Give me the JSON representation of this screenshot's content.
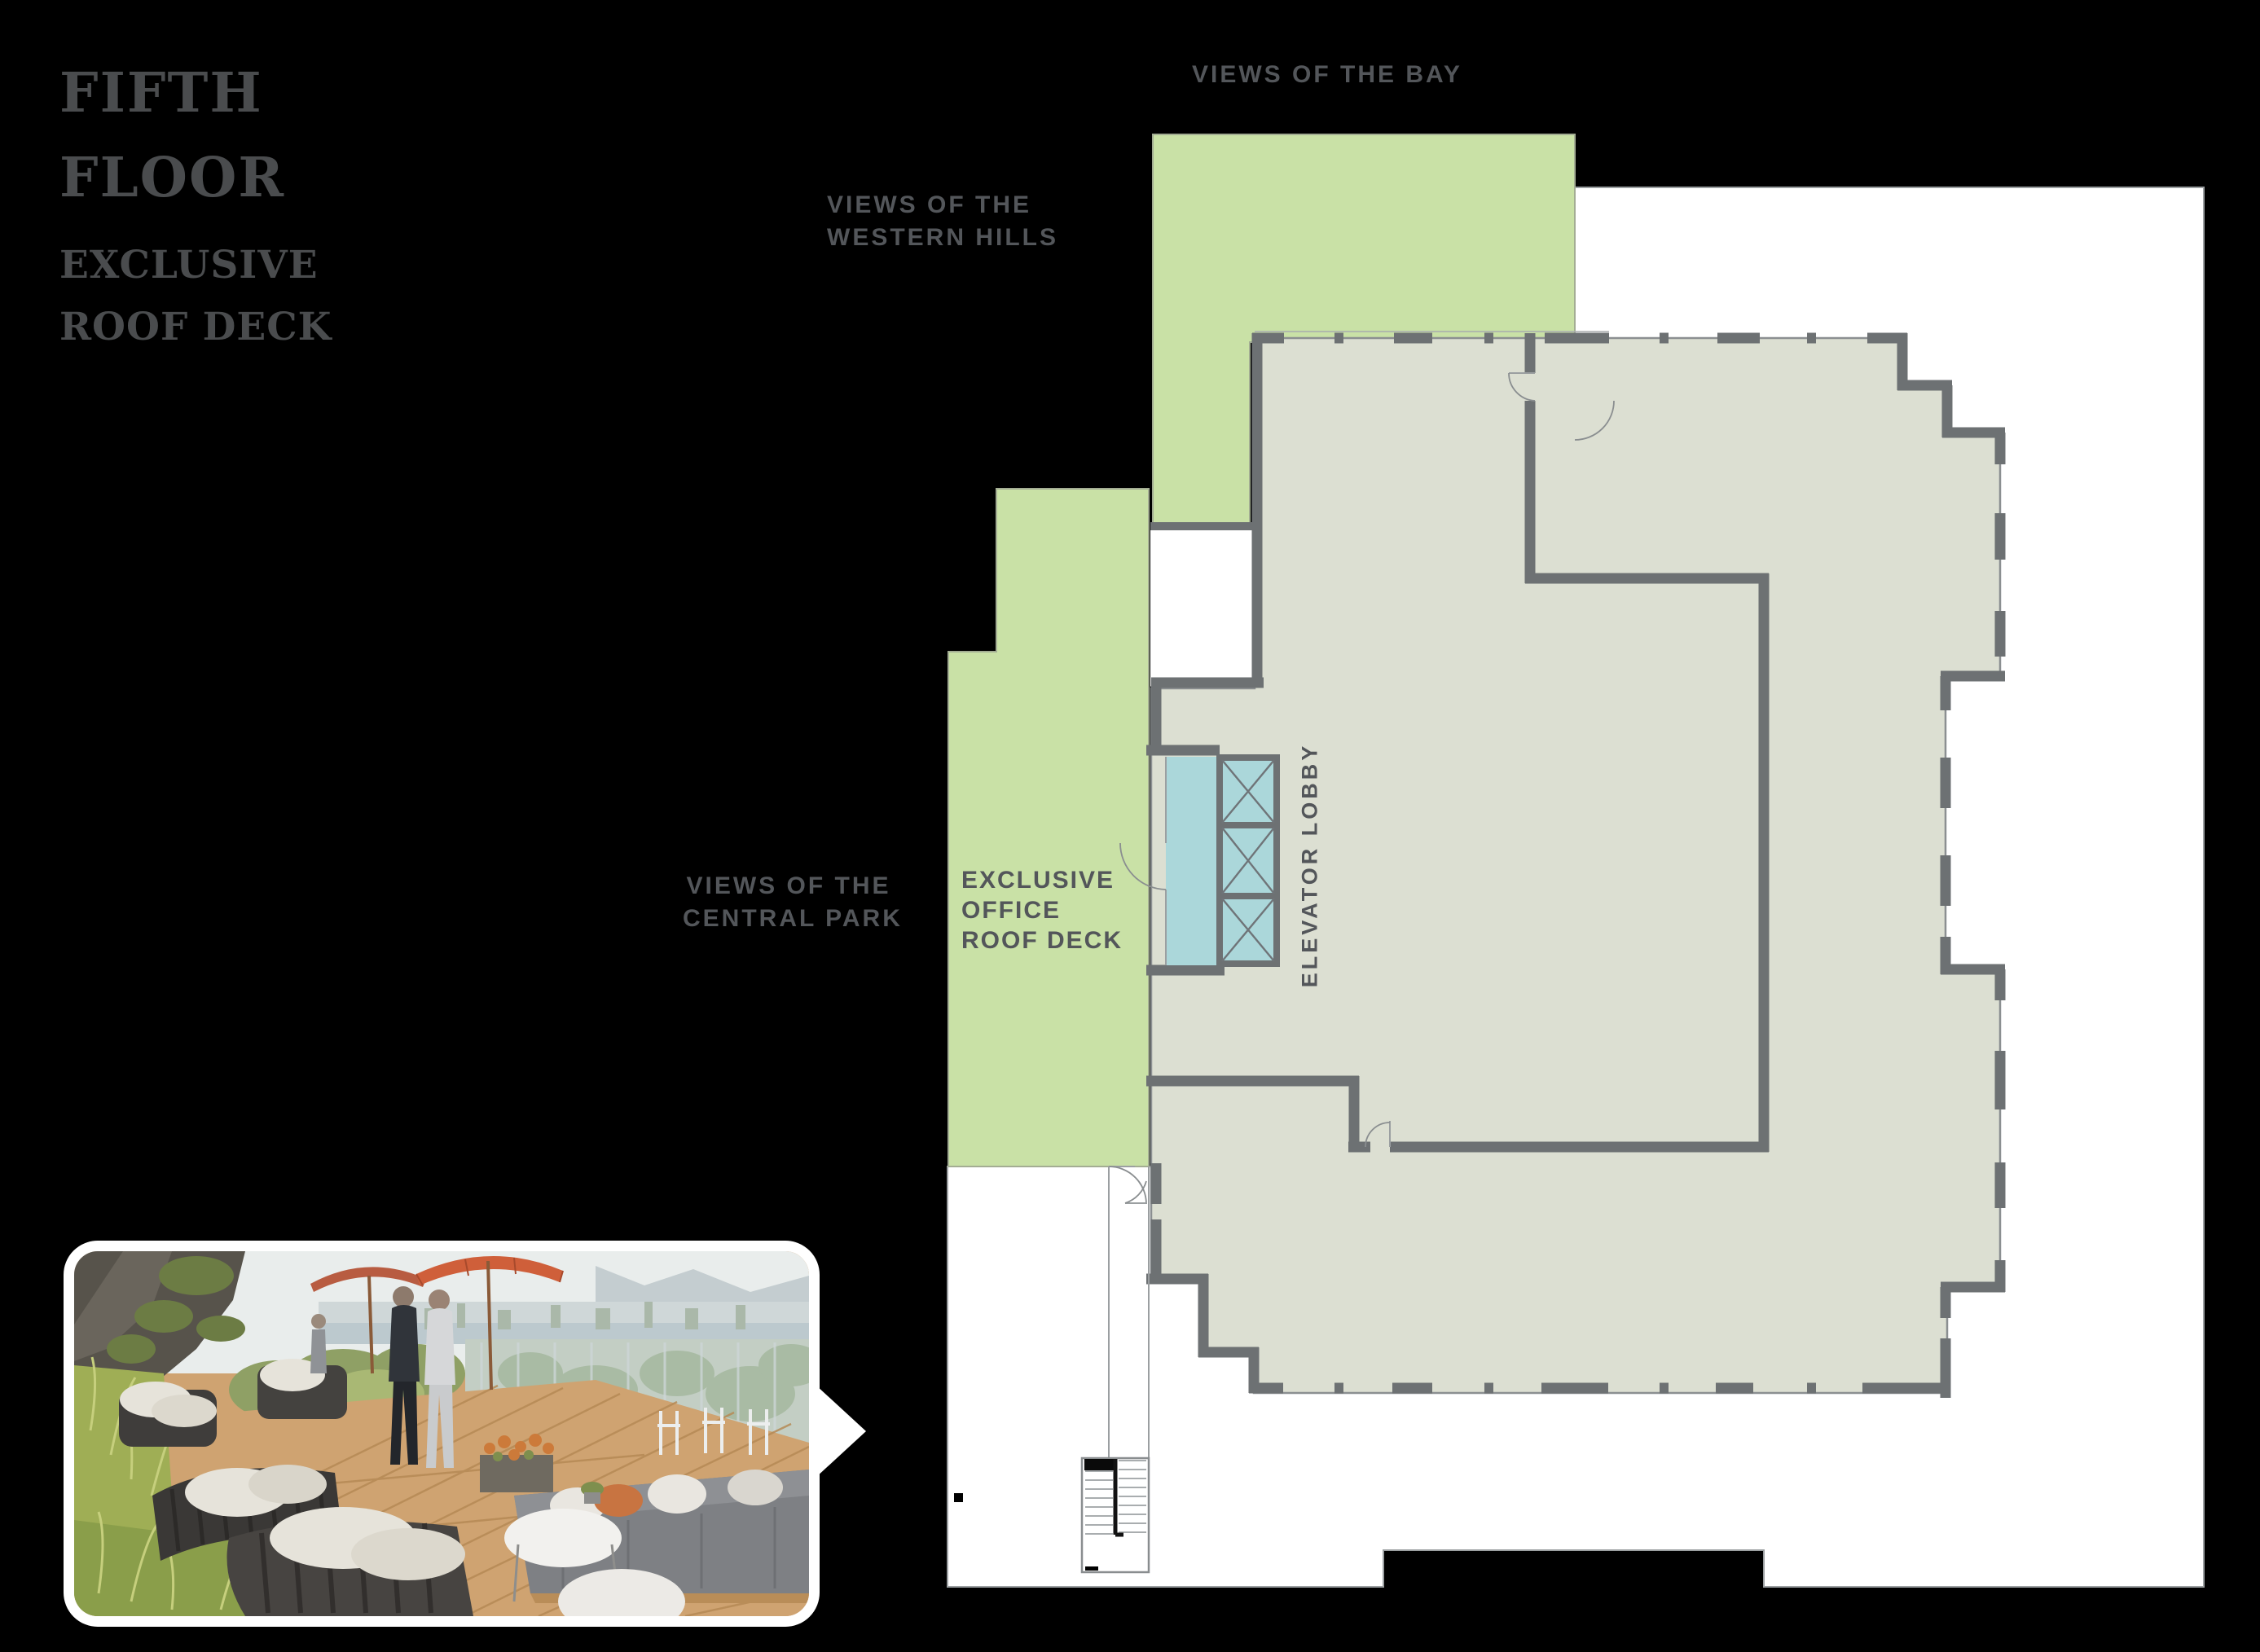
{
  "header": {
    "title_line1": "FIFTH",
    "title_line2": "FLOOR",
    "subtitle_line1": "EXCLUSIVE",
    "subtitle_line2": "ROOF DECK"
  },
  "plan": {
    "labels": {
      "views_bay": "VIEWS OF THE BAY",
      "views_hills_line1": "VIEWS OF THE",
      "views_hills_line2": "WESTERN HILLS",
      "views_park_line1": "VIEWS OF THE",
      "views_park_line2": "CENTRAL PARK",
      "deck_line1": "EXCLUSIVE",
      "deck_line2": "OFFICE",
      "deck_line3": "ROOF DECK",
      "elevator": "ELEVATOR LOBBY"
    }
  },
  "colors": {
    "page-black": "#000000",
    "title-gray": "#4a4c4e",
    "label-gray": "#53565a",
    "deck-green": "#c9e1a6",
    "green-edge": "#a3ad93",
    "floor-gray": "#dcdfd2",
    "floor-edge": "#8b8f91",
    "wall-dark": "#6d7173",
    "elevator-blue": "#abd7da",
    "page-white": "#ffffff",
    "page-edge": "#9b9fa1",
    "thin-line": "#9b9fa1",
    "umbrella-orange": "#cf5f3a",
    "deck-wood": "#cfa371"
  }
}
